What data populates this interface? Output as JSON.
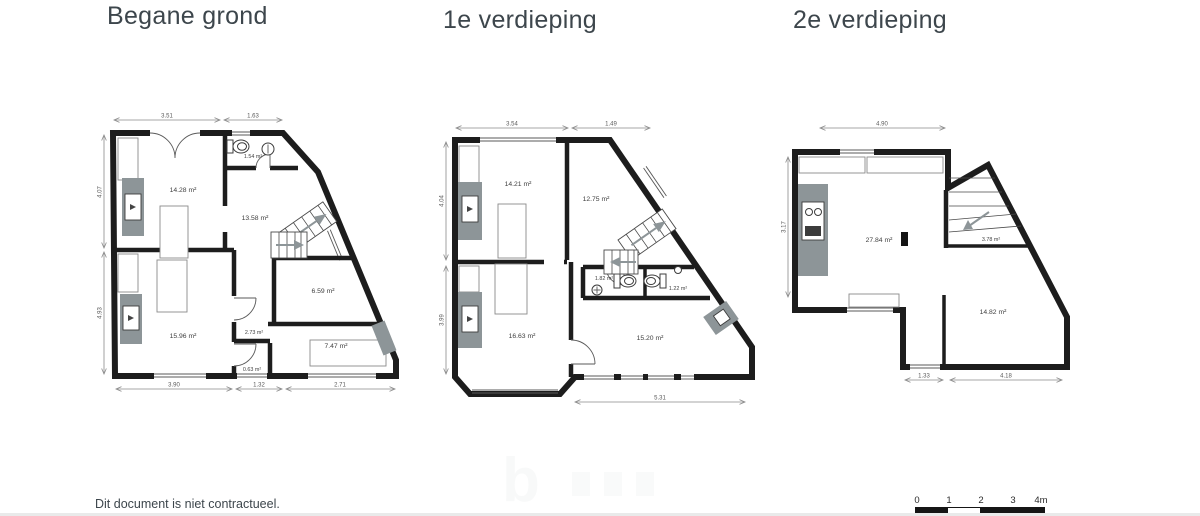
{
  "meta": {
    "footer_note": "Dit document is niet contractueel."
  },
  "colors": {
    "wall": "#1d1d1d",
    "furniture_gray": "#8d9598",
    "dimension_line": "#8a8a8a",
    "label_text": "#3f3f3f",
    "title_text": "#3d464c"
  },
  "plans": [
    {
      "title": "Begane grond",
      "rooms": [
        "14.28 m²",
        "1.54 m²",
        "13.58 m²",
        "15.96 m²",
        "2.73 m²",
        "0.63 m²",
        "6.59 m²",
        "7.47 m²"
      ],
      "dims": {
        "top": [
          "3.51",
          "1.63"
        ],
        "side": [
          "4.07",
          "4.93"
        ],
        "bottom": [
          "3.90",
          "1.32",
          "2.71"
        ]
      }
    },
    {
      "title": "1e verdieping",
      "rooms": [
        "14.21 m²",
        "12.75 m²",
        "1.82 m²",
        "1.22 m²",
        "16.63 m²",
        "15.20 m²"
      ],
      "dims": {
        "top": [
          "3.54",
          "1.49"
        ],
        "side": [
          "4.04",
          "3.99"
        ],
        "bottom": [
          "5.31"
        ]
      }
    },
    {
      "title": "2e verdieping",
      "rooms": [
        "27.84 m²",
        "3.78 m²",
        "14.82 m²"
      ],
      "dims": {
        "top": [
          "4.90"
        ],
        "side": [
          "3.17"
        ],
        "bottom": [
          "1.33",
          "4.18"
        ]
      }
    }
  ],
  "scale_bar": {
    "labels": [
      "0",
      "1",
      "2",
      "3",
      "4m"
    ]
  },
  "watermark": {
    "letter": "b"
  }
}
